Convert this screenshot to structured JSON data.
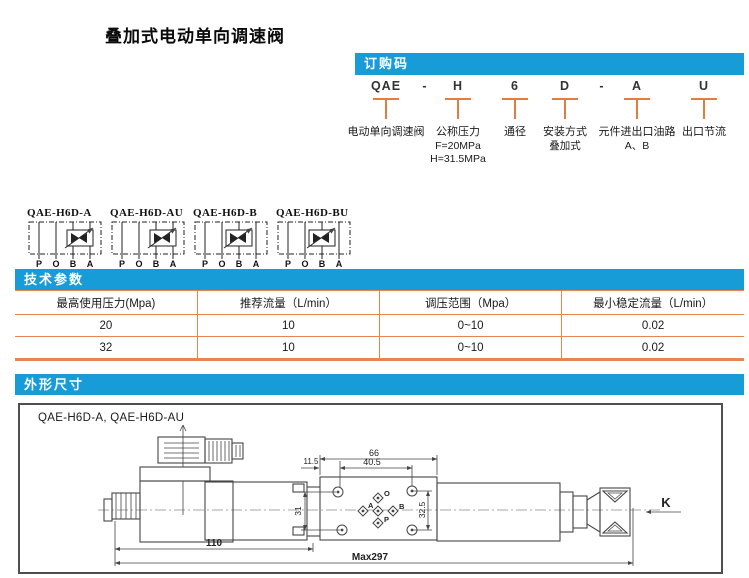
{
  "title": "叠加式电动单向调速阀",
  "colors": {
    "accent_blue": "#189cd8",
    "rule_orange": "#e8854f",
    "drawing_line": "#454545"
  },
  "ordering": {
    "header": "订购码",
    "code": [
      "QAE",
      "-",
      "H",
      "6",
      "D",
      "-",
      "A",
      "U"
    ],
    "labels": [
      {
        "text": "电动单向调速阀",
        "subs": []
      },
      {
        "text": "公称压力",
        "subs": [
          "F=20MPa",
          "H=31.5MPa"
        ]
      },
      {
        "text": "通径",
        "subs": []
      },
      {
        "text": "安装方式",
        "subs": [
          "叠加式"
        ]
      },
      {
        "text": "元件进出口油路",
        "subs": [
          "A、B"
        ]
      },
      {
        "text": "出口节流",
        "subs": []
      }
    ]
  },
  "symbols": {
    "ports": [
      "P",
      "O",
      "B",
      "A"
    ],
    "items": [
      {
        "name": "QAE-H6D-A"
      },
      {
        "name": "QAE-H6D-AU"
      },
      {
        "name": "QAE-H6D-B"
      },
      {
        "name": "QAE-H6D-BU"
      }
    ]
  },
  "specs": {
    "header": "技术参数",
    "columns": [
      "最高使用压力(Mpa)",
      "推荐流量（L/min）",
      "调压范围（Mpa）",
      "最小稳定流量（L/min）"
    ],
    "rows": [
      [
        "20",
        "10",
        "0~10",
        "0.02"
      ],
      [
        "32",
        "10",
        "0~10",
        "0.02"
      ]
    ]
  },
  "outline": {
    "header": "外形尺寸",
    "caption": "QAE-H6D-A, QAE-H6D-AU",
    "view_label": "K",
    "dims": {
      "overall_width": "66",
      "hole_span": "40.5",
      "edge_offset": "11.5",
      "left_height": "31",
      "right_height": "32.5",
      "body_length": "110",
      "max_length": "Max297"
    },
    "ports": {
      "top": "O",
      "left": "A",
      "right": "B",
      "bottom": "P"
    }
  }
}
